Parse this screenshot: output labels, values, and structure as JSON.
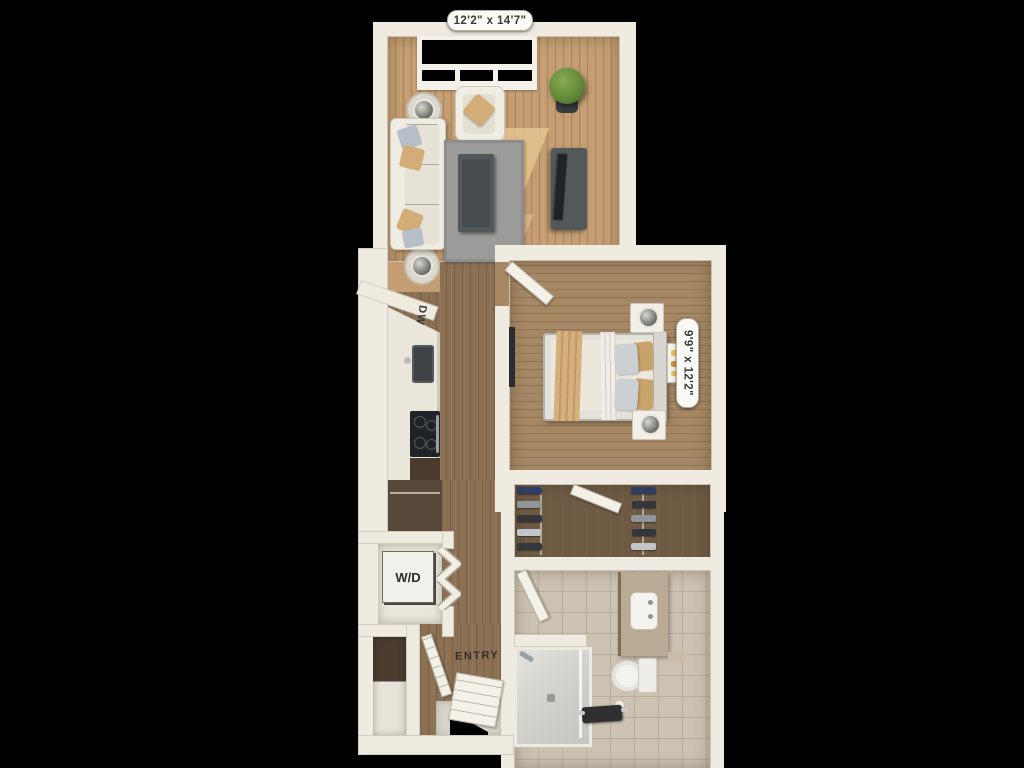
{
  "floorplan": {
    "living_room": {
      "dimensions": "12'2\" x 14'7\""
    },
    "bedroom": {
      "dimensions": "9'9\" x 12'2\""
    },
    "kitchen": {
      "dishwasher_label": "DW"
    },
    "laundry_closet": {
      "washer_dryer_label": "W/D"
    },
    "entry": {
      "label": "ENTRY"
    }
  },
  "colors": {
    "bg": "#000000",
    "wall": "#f0ebe0",
    "wall_edge": "#c9c3b6",
    "living_floor": "#c49d72",
    "hall_floor": "#8b7053",
    "bedroom_floor": "#a58763",
    "closet_floor": "#6e5a43",
    "bath_floor": "#ccc2b2",
    "pantry": "#57483a",
    "stone": "#d8d4ca",
    "rug": "#9b9c99",
    "sofa": "#efece4",
    "pillow_tan": "#d2ad78",
    "pillow_blue": "#b6bfc7",
    "furniture_dark": "#53585a",
    "tv_dark": "#212426",
    "plant": "#5f8738",
    "pot": "#3a3d3f",
    "blanket": "#d5b07c",
    "appliance_dark": "#1f2325",
    "clothes_navy": "#2e3d63",
    "clothes_gray": "#8f959b",
    "clothes_dark": "#33373c",
    "label_text": "#3a3a3a",
    "pill_bg": "#fbfaf6"
  }
}
